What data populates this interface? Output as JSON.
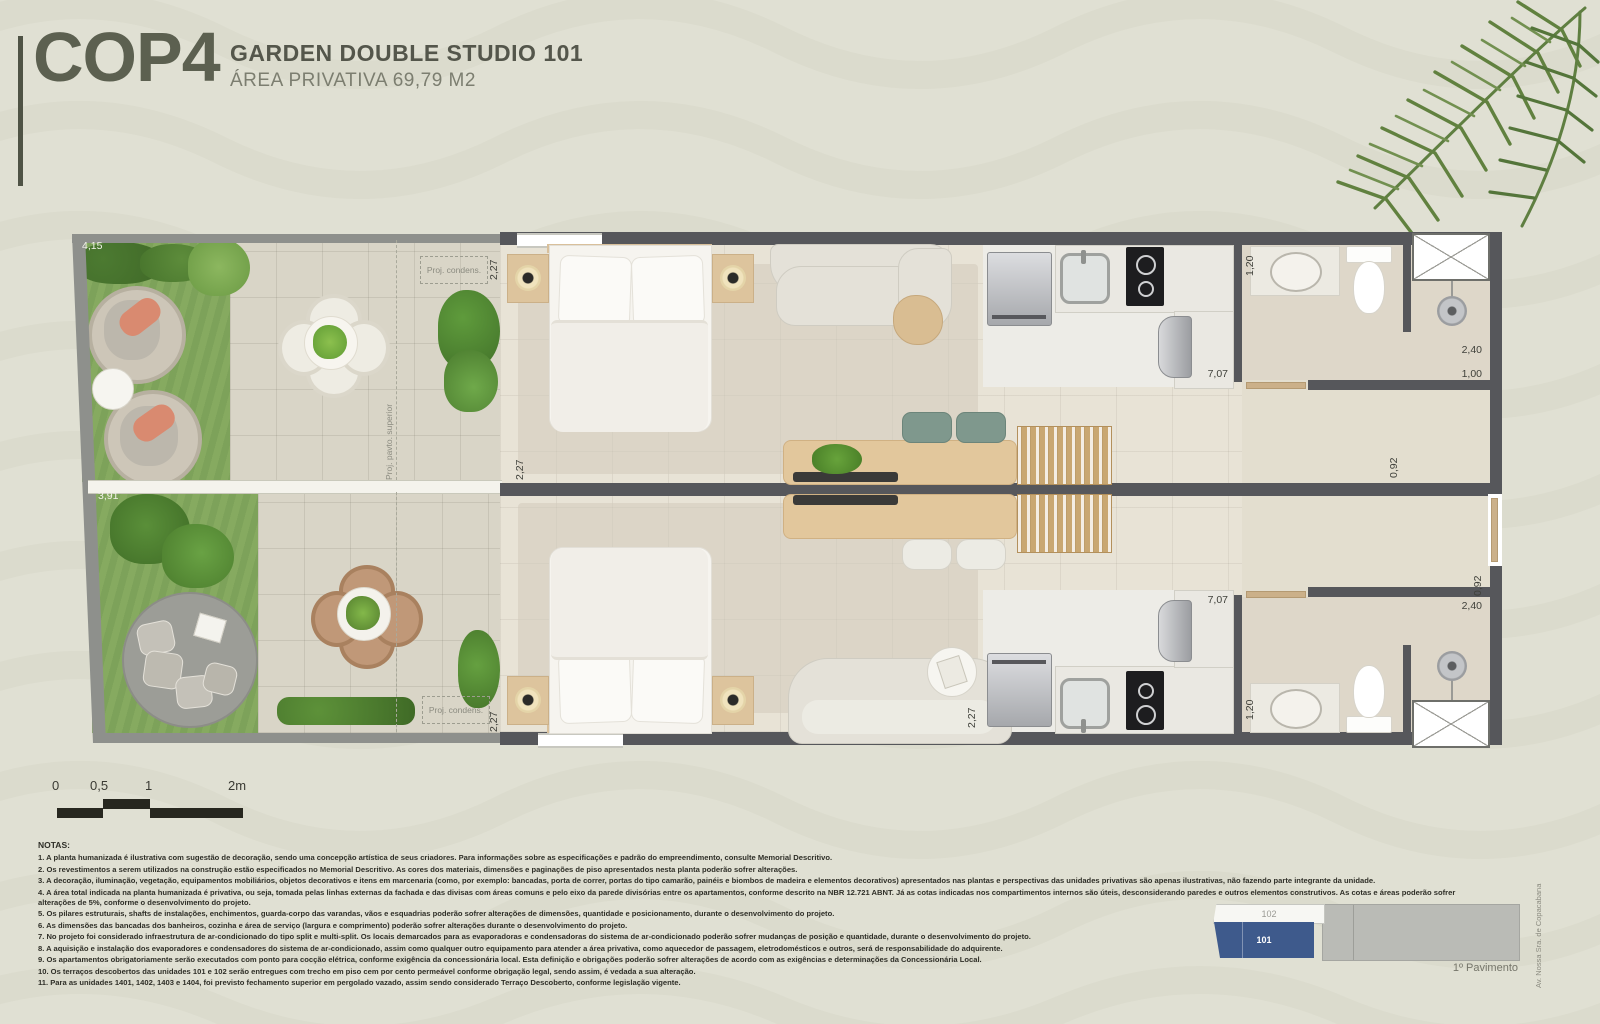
{
  "header": {
    "logo_text": "COP4",
    "title": "GARDEN DOUBLE STUDIO 101",
    "subtitle": "ÁREA PRIVATIVA 69,79 M2"
  },
  "plan": {
    "dims": {
      "d415": "4,15",
      "d391": "3,91",
      "d227": "2,27",
      "d120": "1,20",
      "d707": "7,07",
      "d240": "2,40",
      "d100": "1,00",
      "d092": "0,92"
    },
    "labels": {
      "proj_condens": "Proj. condens.",
      "proj_pavto": "Proj. pavto. superior"
    }
  },
  "scalebar": {
    "ticks": [
      "0",
      "0,5",
      "1",
      "2m"
    ]
  },
  "notes": {
    "title": "NOTAS:",
    "items": [
      "1. A planta humanizada é ilustrativa com sugestão de decoração, sendo uma concepção artística de seus criadores. Para informações sobre as especificações e padrão do empreendimento, consulte Memorial Descritivo.",
      "2. Os revestimentos a serem utilizados na construção estão especificados no Memorial Descritivo. As cores dos materiais, dimensões e paginações de piso apresentados nesta planta poderão sofrer alterações.",
      "3. A decoração, iluminação, vegetação, equipamentos mobiliários, objetos decorativos e itens em marcenaria (como, por exemplo: bancadas, porta de correr, portas do tipo camarão, painéis e biombos de madeira e elementos decorativos) apresentados nas plantas e perspectivas das unidades privativas são apenas ilustrativas, não fazendo parte integrante da unidade.",
      "4. A área total indicada na planta humanizada é privativa, ou seja, tomada pelas linhas externas da fachada e das divisas com áreas comuns e pelo eixo da parede divisórias entre os apartamentos, conforme descrito na NBR 12.721 ABNT. Já as cotas indicadas nos compartimentos internos são úteis, desconsiderando paredes e outros elementos construtivos. As cotas e áreas poderão sofrer alterações de 5%, conforme o desenvolvimento do projeto.",
      "5. Os pilares estruturais, shafts de instalações, enchimentos, guarda-corpo das varandas, vãos e esquadrias poderão sofrer alterações de dimensões, quantidade e posicionamento, durante o desenvolvimento do projeto.",
      "6. As dimensões das bancadas dos banheiros, cozinha e área de serviço (largura e comprimento) poderão sofrer alterações durante o desenvolvimento do projeto.",
      "7. No projeto foi considerado infraestrutura de ar-condicionado do tipo split e multi-split. Os locais demarcados para as evaporadoras e condensadoras do sistema de ar-condicionado poderão sofrer mudanças de posição e quantidade, durante o desenvolvimento do projeto.",
      "8. A aquisição e instalação dos evaporadores e condensadores do sistema de ar-condicionado, assim como qualquer outro equipamento para atender a área privativa, como aquecedor de passagem, eletrodomésticos e outros, será de responsabilidade do adquirente.",
      "9. Os apartamentos obrigatoriamente serão executados com ponto para cocção elétrica, conforme exigência da concessionária local. Esta definição e obrigações poderão sofrer alterações de acordo com as exigências e determinações da Concessionária Local.",
      "10. Os terraços descobertos das unidades 101 e 102 serão entregues com trecho em piso cem por cento permeável conforme obrigação legal, sendo assim, é vedada a sua alteração.",
      "11. Para as unidades 1401, 1402, 1403 e 1404, foi previsto fechamento superior em pergolado vazado, assim sendo considerado Terraço Descoberto, conforme legislação vigente."
    ]
  },
  "keyplan": {
    "other_unit": "102",
    "highlight_unit": "101",
    "floor_label": "1º Pavimento",
    "street_label": "Av. Nossa Sra. de Copacabana",
    "highlight_color": "#3e5a8c"
  },
  "colors": {
    "brand_text": "#5c6050",
    "wall": "#56575b",
    "grass": "#83a75e",
    "keyplan_highlight": "#3e5a8c",
    "lounge_pillow": "#d98a70"
  }
}
